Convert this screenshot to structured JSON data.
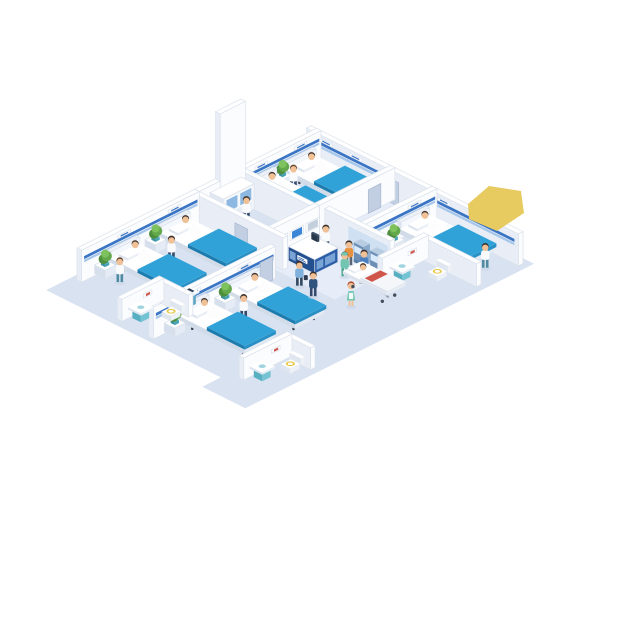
{
  "meta": {
    "description": "Isometric cutaway illustration of a hospital floor: patient wards with beds, nurses, a reception desk, self check-in kiosks, bathrooms, a lab room and a patient on a gurney."
  },
  "palette": {
    "floor": "#d9e2f1",
    "floorLight": "#e6edf8",
    "wallTop": "#ffffff",
    "wallSE": "#fbfcfe",
    "wallSW": "#e9eef6",
    "wallEdge": "#dbe2ec",
    "stripeBlue": "#3a74c4",
    "stripeLight": "#a6c6ea",
    "blanketTop": "#31a2d8",
    "blanketSE": "#2890c5",
    "blanketSW": "#1d7cae",
    "mattressSE": "#e3e9f2",
    "mattressSW": "#d2dbe8",
    "legDark": "#3c4450",
    "skin": "#f0c196",
    "hairDark": "#3c2e28",
    "hairBrown": "#6b4a35",
    "hairRed": "#b0452e",
    "coatWhite": "#f8fafc",
    "navyPants": "#34496b",
    "tealPants": "#4e8ba0",
    "grayPants": "#5a6573",
    "darkPants": "#33475e",
    "orangeShirt": "#e8923f",
    "denimBlue": "#4a7fc1",
    "lightBlueShirt": "#7fb1dc",
    "navyShirt": "#31547f",
    "scrubTeal": "#72c6b1",
    "scrubDark": "#4fa892",
    "plantGreen": "#4e8f3f",
    "plantMid": "#63a94b",
    "plantLight": "#7ec25e",
    "potTeal": "#4fb0c4",
    "cabSE": "#e6ecf5",
    "cabSW": "#d6dfec",
    "deskBlue": "#2d5fa8",
    "deskBlueDark": "#24508f",
    "deskPanel": "#7aa3d6",
    "screenBlue": "#3b86d6",
    "screenGray": "#c3cfdd",
    "kioskBody": "#8aa9c9",
    "kioskDark": "#6d8fb5",
    "kioskScreen": "#d8eafc",
    "toiletSeat": "#e7c94f",
    "sinkTop": "#bfe0ea",
    "sinkSE": "#74c3d2",
    "sinkSW": "#57b0c2",
    "water": "#9fd4e0",
    "doorFill": "#c2cfe2",
    "doorEdge": "#a9b8d0",
    "shadow": "#c5d1e2",
    "highlight": "#e8cb60",
    "gurneyRed": "#d0564a",
    "panelBlue": "#cfe0f2",
    "labDoorBlue": "#8db8e2",
    "monitorDark": "#2f4156",
    "monitorLight": "#3d5570"
  },
  "scene": {
    "origin": {
      "x": 300,
      "y": 152
    },
    "unit": {
      "w": 21,
      "h": 10.5,
      "z": 11
    },
    "bed": {
      "l": 3.2,
      "w": 1.4
    },
    "items": [
      {
        "kind": "floor",
        "name": "hospital-floor",
        "color": "floor",
        "pts": [
          [
            0.53,
            -0.25
          ],
          [
            10.9,
            -0.25
          ],
          [
            10.9,
            13.5
          ],
          [
            8.85,
            13.5
          ],
          [
            8.85,
            12.62
          ],
          [
            0.53,
            12.62
          ]
        ]
      },
      {
        "kind": "floor",
        "name": "corridor-floor-patch",
        "color": "floorLight",
        "pts": [
          [
            4.35,
            3.58
          ],
          [
            7.85,
            3.58
          ],
          [
            7.85,
            6.2
          ],
          [
            4.35,
            6.2
          ]
        ]
      },
      {
        "kind": "floor",
        "name": "entry-floor-patch",
        "color": "floorLight",
        "pts": [
          [
            4.4,
            0.25
          ],
          [
            6.2,
            0.25
          ],
          [
            6.2,
            3.3
          ],
          [
            4.4,
            3.3
          ]
        ]
      },
      {
        "kind": "wall",
        "name": "outer-ne-wall",
        "type": "u",
        "v": 0,
        "u0": 0.53,
        "u1": 10.62,
        "stripes": [
          [
            0.9,
            4.1
          ],
          [
            6.45,
            10.45
          ]
        ],
        "doors": [
          [
            4.35,
            4.95
          ]
        ],
        "plaques": [
          1.5,
          2.9,
          7.1
        ]
      },
      {
        "kind": "wall",
        "name": "top-ward-headboard-wall",
        "type": "v",
        "u": 0.78,
        "v0": 0,
        "v1": 3.6,
        "stripe": true,
        "plaques": [
          1.0,
          2.88
        ]
      },
      {
        "kind": "bed",
        "name": "bed-top-a",
        "u": 0.95,
        "v": 0.3
      },
      {
        "kind": "cabinet",
        "name": "plant-cabinet-top",
        "u": 0.9,
        "v": 1.73,
        "s": 0.42
      },
      {
        "kind": "person",
        "name": "nurse-top-ward",
        "u": 1.62,
        "v": 1.93,
        "shirt": "coatWhite",
        "pants": "navyPants",
        "hair": "hairBrown"
      },
      {
        "kind": "bed",
        "name": "bed-top-b",
        "u": 0.95,
        "v": 2.18
      },
      {
        "kind": "wall",
        "name": "top-ward-se-wall",
        "type": "v",
        "u": 4.3,
        "v0": 0,
        "v1": 3.6,
        "doors": [
          [
            0.7,
            1.3
          ]
        ]
      },
      {
        "kind": "wall",
        "name": "lab-ne-wall",
        "type": "u",
        "v": 3.6,
        "u0": 0.78,
        "u1": 4.3
      },
      {
        "kind": "wall",
        "name": "lab-nw-tall-wall",
        "type": "v",
        "u": 0.78,
        "v0": 3.6,
        "v1": 4.8,
        "h": 9
      },
      {
        "kind": "wall",
        "name": "lab-nw-wall",
        "type": "v",
        "u": 0.78,
        "v0": 4.8,
        "v1": 5.8
      },
      {
        "kind": "labcab",
        "name": "lab-cabinet"
      },
      {
        "kind": "person",
        "name": "lab-technician",
        "u": 2.0,
        "v": 4.55,
        "shirt": "coatWhite",
        "pants": "navyPants"
      },
      {
        "kind": "wall",
        "name": "lab-se-wall",
        "type": "v",
        "u": 4.3,
        "v0": 3.6,
        "v1": 5.8,
        "displays": [
          {
            "v": 3.95,
            "screen": "screenGray"
          },
          {
            "v": 4.7,
            "screen": "screenBlue"
          },
          {
            "v": 5.45,
            "screen": "screenGray"
          }
        ]
      },
      {
        "kind": "wall",
        "name": "right-ward-headboard-wall",
        "type": "v",
        "u": 6.3,
        "v0": 0,
        "v1": 3.4,
        "stripe": true,
        "plaques": [
          1.1
        ]
      },
      {
        "kind": "bed",
        "name": "bed-right-ward",
        "u": 6.45,
        "v": 0.4
      },
      {
        "kind": "cabinet",
        "name": "plant-cabinet-right",
        "u": 6.56,
        "v": 2.1,
        "s": 0.5
      },
      {
        "kind": "person",
        "name": "nurse-right-ward",
        "u": 9.92,
        "v": 1.1,
        "shirt": "coatWhite",
        "pants": "tealPants"
      },
      {
        "kind": "wall",
        "name": "kiosk-wall",
        "type": "u",
        "v": 3.4,
        "u0": 4.8,
        "u1": 7.9,
        "panel": [
          5.95,
          7.85
        ]
      },
      {
        "kind": "kiosk",
        "name": "checkin-kiosk-1",
        "u": 6.5,
        "v": 3.62
      },
      {
        "kind": "kiosk",
        "name": "checkin-kiosk-2",
        "u": 7.28,
        "v": 3.62
      },
      {
        "kind": "person",
        "name": "kiosk-user-orange",
        "u": 6.55,
        "v": 4.22,
        "shirt": "orangeShirt",
        "pants": "grayPants"
      },
      {
        "kind": "person",
        "name": "kiosk-user-blue",
        "u": 7.35,
        "v": 4.3,
        "shirt": "denimBlue",
        "pants": "darkPants"
      },
      {
        "kind": "wall",
        "name": "right-bathroom-ne-wall",
        "type": "u",
        "v": 2.0,
        "u0": 7.9,
        "u1": 10.62,
        "h": 2.1
      },
      {
        "kind": "wall",
        "name": "right-bathroom-nw-wall",
        "type": "v",
        "u": 7.9,
        "v0": 2.0,
        "v1": 4.2,
        "h": 2.1,
        "picture": {
          "v0": 2.6,
          "v1": 3.0
        }
      },
      {
        "kind": "sink",
        "name": "right-bathroom-sink",
        "u": 8.18,
        "v": 3.32
      },
      {
        "kind": "toilet",
        "name": "right-bathroom-toilet",
        "u": 8.92,
        "v": 2.28
      },
      {
        "kind": "person",
        "name": "receptionist",
        "u": 5.25,
        "v": 4.02,
        "shirt": "coatWhite",
        "pants": "navyPants",
        "hair": "hairDark"
      },
      {
        "kind": "desk",
        "name": "reception-desk"
      },
      {
        "kind": "wall",
        "name": "left-ward-ne-wall",
        "type": "u",
        "v": 5.8,
        "u0": 0.78,
        "u1": 5.2,
        "doors": [
          [
            2.95,
            3.55
          ]
        ]
      },
      {
        "kind": "wall",
        "name": "left-ward-headboard-wall",
        "type": "v",
        "u": 0.78,
        "v0": 5.8,
        "v1": 11.4,
        "stripe": true,
        "plaques": [
          7.0,
          9.4
        ]
      },
      {
        "kind": "bed",
        "name": "bed-left-a",
        "u": 0.95,
        "v": 6.3
      },
      {
        "kind": "cabinet",
        "name": "plant-cabinet-left-1",
        "u": 0.9,
        "v": 7.78,
        "s": 0.5
      },
      {
        "kind": "person",
        "name": "nurse-left-ward-1",
        "u": 2.1,
        "v": 8.22,
        "shirt": "coatWhite",
        "pants": "navyPants"
      },
      {
        "kind": "bed",
        "name": "bed-left-b",
        "u": 0.95,
        "v": 8.7
      },
      {
        "kind": "cabinet",
        "name": "plant-cabinet-left-2",
        "u": 0.9,
        "v": 10.18,
        "s": 0.5
      },
      {
        "kind": "person",
        "name": "nurse-left-ward-2",
        "u": 1.9,
        "v": 10.48,
        "shirt": "coatWhite",
        "pants": "tealPants",
        "hair": "hairBrown"
      },
      {
        "kind": "wall",
        "name": "center-ward-headboard-wall",
        "type": "v",
        "u": 5.2,
        "v0": 6.6,
        "v1": 12.4,
        "stripe": true,
        "plaques": [
          8.1,
          10.5
        ],
        "doors": [
          [
            6.75,
            7.35
          ]
        ]
      },
      {
        "kind": "bed",
        "name": "bed-center-a",
        "u": 5.35,
        "v": 7.4
      },
      {
        "kind": "cabinet",
        "name": "plant-cabinet-center-1",
        "u": 5.32,
        "v": 8.88,
        "s": 0.5
      },
      {
        "kind": "person",
        "name": "nurse-center-ward",
        "u": 6.6,
        "v": 9.28,
        "shirt": "coatWhite",
        "pants": "navyPants"
      },
      {
        "kind": "bed",
        "name": "bed-center-b",
        "u": 5.35,
        "v": 9.8
      },
      {
        "kind": "cabinet",
        "name": "plant-cabinet-center-2",
        "u": 5.32,
        "v": 11.28,
        "s": 0.5
      },
      {
        "kind": "person",
        "name": "visitor-lightblue",
        "u": 6.35,
        "v": 6.38,
        "shirt": "lightBlueShirt",
        "pants": "darkPants",
        "bag": true
      },
      {
        "kind": "person",
        "name": "visitor-navy",
        "u": 7.18,
        "v": 6.55,
        "shirt": "navyShirt",
        "pants": "navyPants"
      },
      {
        "kind": "person",
        "name": "nurse-walking-green",
        "u": 8.55,
        "v": 6.12,
        "dress": true,
        "shirt": "scrubTeal",
        "hair": "hairRed"
      },
      {
        "kind": "person",
        "name": "orderly-pushing-gurney",
        "u": 6.98,
        "v": 4.85,
        "shirt": "scrubTeal",
        "pants": "scrubDark",
        "cap": true
      },
      {
        "kind": "gurney",
        "name": "patient-gurney",
        "u": 7.35,
        "v": 4.42
      },
      {
        "kind": "lectern",
        "name": "info-stand"
      },
      {
        "kind": "wall",
        "name": "left-bathroom-ne-wall",
        "type": "u",
        "v": 10.3,
        "u0": 3.6,
        "u1": 5.2,
        "h": 2.0
      },
      {
        "kind": "wall",
        "name": "left-bathroom-nw-wall",
        "type": "v",
        "u": 3.6,
        "v0": 10.3,
        "v1": 12.3,
        "h": 2.0,
        "picture": {
          "v0": 10.9,
          "v1": 11.3
        }
      },
      {
        "kind": "sink",
        "name": "left-bathroom-sink",
        "u": 3.92,
        "v": 11.5
      },
      {
        "kind": "toilet",
        "name": "left-bathroom-toilet",
        "u": 4.48,
        "v": 10.52
      },
      {
        "kind": "wall",
        "name": "center-bathroom-ne-wall",
        "type": "u",
        "v": 9.9,
        "u0": 9.3,
        "u1": 10.62,
        "h": 2.0
      },
      {
        "kind": "wall",
        "name": "center-bathroom-nw-wall",
        "type": "v",
        "u": 9.3,
        "v0": 9.9,
        "v1": 12.2,
        "h": 2.0,
        "picture": {
          "v0": 10.5,
          "v1": 10.9
        }
      },
      {
        "kind": "sink",
        "name": "center-bathroom-sink",
        "u": 9.62,
        "v": 11.42
      },
      {
        "kind": "toilet",
        "name": "center-bathroom-toilet",
        "u": 9.82,
        "v": 10.18
      },
      {
        "kind": "screenpoly",
        "name": "yellow-highlight",
        "color": "highlight",
        "pts": [
          [
            468,
            204
          ],
          [
            489,
            186
          ],
          [
            521,
            191
          ],
          [
            524,
            213
          ],
          [
            497,
            231
          ],
          [
            469,
            219
          ]
        ]
      }
    ]
  }
}
